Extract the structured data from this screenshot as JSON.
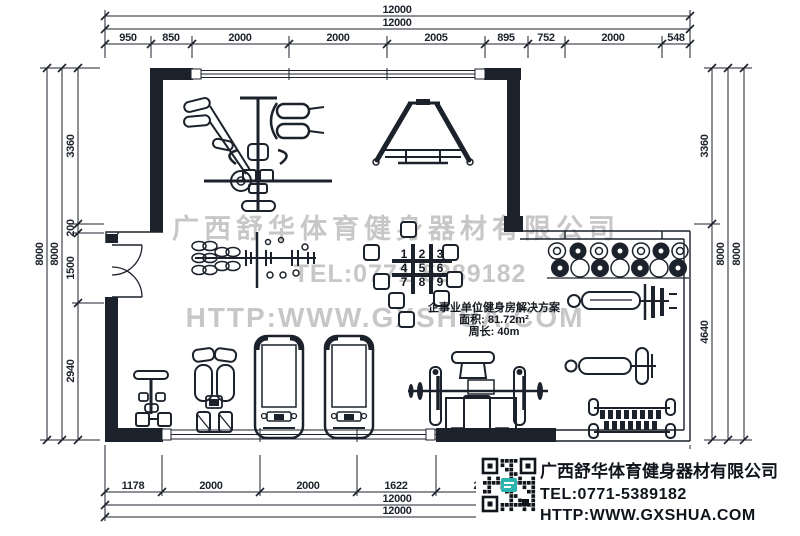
{
  "colors": {
    "ink": "#1c222b",
    "watermark": "#c7c7c7",
    "qr_logo": "#2ab5af"
  },
  "watermark": {
    "company": "广西舒华体育健身器材有限公司",
    "tel": "TEL:0771-5389182",
    "website": "HTTP:WWW.GXSHUA.COM"
  },
  "solution_box": {
    "title": "企事业单位健身房解决方案",
    "area": "面积: 81.72m²",
    "perimeter": "周长: 40m"
  },
  "info_box": {
    "company": "广西舒华体育健身器材有限公司",
    "tel": "TEL:0771-5389182",
    "website": "HTTP:WWW.GXSHUA.COM",
    "qr": "qr-code"
  },
  "dims": {
    "top": {
      "total_outer": "12000",
      "total_inner": "12000",
      "segments": [
        "950",
        "850",
        "2000",
        "2000",
        "2005",
        "895",
        "752",
        "2000",
        "548"
      ]
    },
    "bottom": {
      "total_outer": "12000",
      "total_inner": "12000",
      "segments": [
        "1178",
        "2000",
        "2000",
        "1622",
        "2000"
      ]
    },
    "left": {
      "totals": [
        "8000",
        "8000"
      ],
      "segments": [
        "3360",
        "200",
        "1500",
        "2940"
      ]
    },
    "right": {
      "totals": [
        "8000",
        "8000"
      ],
      "segments": [
        "3360",
        "4640"
      ]
    }
  },
  "stations": [
    "1",
    "2",
    "3",
    "4",
    "5",
    "6",
    "7",
    "8",
    "9"
  ]
}
